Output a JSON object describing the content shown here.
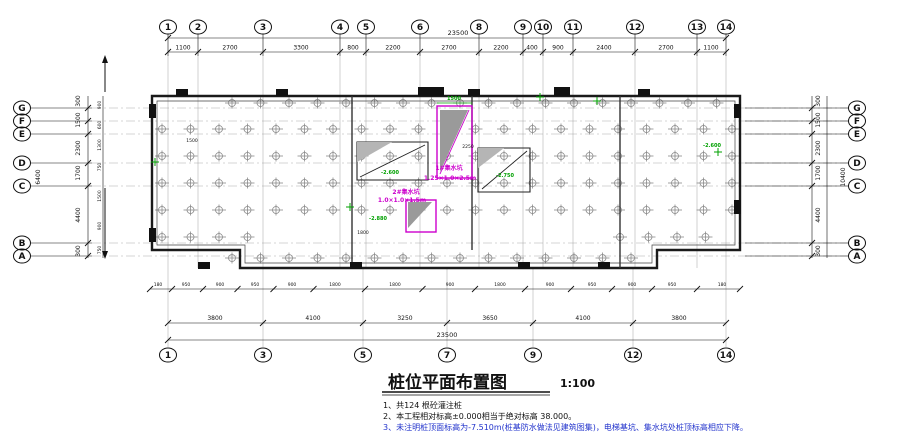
{
  "drawing": {
    "title": "桩位平面布置图",
    "scale": "1:100",
    "notes": [
      "1、共124 根砼灌注桩",
      "2、本工程相对标高±0.000相当于绝对标高 38.000。",
      "3、未注明桩顶面标高为-7.510m(桩基防水做法见建筑图集)，电梯基坑、集水坑处桩顶标高相应下降。"
    ],
    "colors": {
      "line": "#1a1a1a",
      "grid": "#999999",
      "pile": "#8a8a8a",
      "annotation_magenta": "#cc00cc",
      "elevation_green": "#00a000",
      "note3_blue": "#2233cc"
    }
  },
  "top_axis": {
    "bubbles": [
      {
        "label": "1",
        "x": 168
      },
      {
        "label": "2",
        "x": 198
      },
      {
        "label": "3",
        "x": 263
      },
      {
        "label": "4",
        "x": 340
      },
      {
        "label": "5",
        "x": 366
      },
      {
        "label": "6",
        "x": 420
      },
      {
        "label": "8",
        "x": 479
      },
      {
        "label": "9",
        "x": 523
      },
      {
        "label": "10",
        "x": 543
      },
      {
        "label": "11",
        "x": 573
      },
      {
        "label": "12",
        "x": 635
      },
      {
        "label": "13",
        "x": 697
      },
      {
        "label": "14",
        "x": 726
      }
    ],
    "dims": [
      {
        "text": "1100",
        "x": 183
      },
      {
        "text": "2700",
        "x": 230
      },
      {
        "text": "3300",
        "x": 301
      },
      {
        "text": "800",
        "x": 353
      },
      {
        "text": "2200",
        "x": 393
      },
      {
        "text": "2700",
        "x": 449
      },
      {
        "text": "2200",
        "x": 501
      },
      {
        "text": "400",
        "x": 532
      },
      {
        "text": "900",
        "x": 558
      },
      {
        "text": "2400",
        "x": 604
      },
      {
        "text": "2700",
        "x": 666
      },
      {
        "text": "1100",
        "x": 711
      }
    ],
    "total": "23500"
  },
  "bottom_axis": {
    "bubbles": [
      {
        "label": "1",
        "x": 168
      },
      {
        "label": "3",
        "x": 263
      },
      {
        "label": "5",
        "x": 363
      },
      {
        "label": "7",
        "x": 447
      },
      {
        "label": "9",
        "x": 533
      },
      {
        "label": "12",
        "x": 633
      },
      {
        "label": "14",
        "x": 726
      }
    ],
    "dims": [
      {
        "text": "3800",
        "x": 215
      },
      {
        "text": "4100",
        "x": 313
      },
      {
        "text": "3250",
        "x": 405
      },
      {
        "text": "3650",
        "x": 490
      },
      {
        "text": "4100",
        "x": 583
      },
      {
        "text": "3800",
        "x": 679
      }
    ],
    "total": "23500"
  },
  "left_axis": {
    "bubbles": [
      {
        "label": "G",
        "y": 108
      },
      {
        "label": "F",
        "y": 121
      },
      {
        "label": "E",
        "y": 134
      },
      {
        "label": "D",
        "y": 163
      },
      {
        "label": "C",
        "y": 186
      },
      {
        "label": "B",
        "y": 243
      },
      {
        "label": "A",
        "y": 256
      }
    ],
    "dims": [
      {
        "text": "300",
        "y": 101
      },
      {
        "text": "1500",
        "y": 120
      },
      {
        "text": "2300",
        "y": 148
      },
      {
        "text": "1700",
        "y": 173
      },
      {
        "text": "4400",
        "y": 215
      },
      {
        "text": "300",
        "y": 251
      }
    ],
    "inner_dims": [
      {
        "text": "900",
        "y": 105
      },
      {
        "text": "600",
        "y": 125
      },
      {
        "text": "1300",
        "y": 145
      },
      {
        "text": "750",
        "y": 167
      },
      {
        "text": "1500",
        "y": 196
      },
      {
        "text": "900",
        "y": 226
      },
      {
        "text": "750",
        "y": 250
      }
    ],
    "overall": "6400"
  },
  "right_axis": {
    "bubbles": [
      {
        "label": "G",
        "y": 108
      },
      {
        "label": "F",
        "y": 121
      },
      {
        "label": "E",
        "y": 134
      },
      {
        "label": "D",
        "y": 163
      },
      {
        "label": "C",
        "y": 186
      },
      {
        "label": "B",
        "y": 243
      },
      {
        "label": "A",
        "y": 256
      }
    ],
    "dims": [
      {
        "text": "300",
        "y": 101
      },
      {
        "text": "1500",
        "y": 120
      },
      {
        "text": "2300",
        "y": 148
      },
      {
        "text": "1700",
        "y": 173
      },
      {
        "text": "4400",
        "y": 215
      },
      {
        "text": "300",
        "y": 251
      }
    ],
    "overall": "10400"
  },
  "small_dims_row": [
    {
      "text": "180",
      "x": 158
    },
    {
      "text": "950",
      "x": 186
    },
    {
      "text": "900",
      "x": 220
    },
    {
      "text": "950",
      "x": 255
    },
    {
      "text": "900",
      "x": 292
    },
    {
      "text": "1800",
      "x": 335
    },
    {
      "text": "1800",
      "x": 395
    },
    {
      "text": "900",
      "x": 450
    },
    {
      "text": "1800",
      "x": 500
    },
    {
      "text": "900",
      "x": 550
    },
    {
      "text": "950",
      "x": 592
    },
    {
      "text": "900",
      "x": 632
    },
    {
      "text": "950",
      "x": 672
    },
    {
      "text": "180",
      "x": 722
    }
  ],
  "pit_labels": [
    {
      "text": "1#集水坑",
      "x": 449,
      "y": 170
    },
    {
      "text": "1.25×1.0×2.5m",
      "x": 450,
      "y": 180
    },
    {
      "text": "2#集水坑",
      "x": 406,
      "y": 194
    },
    {
      "text": "1.0×1.0×1.5m",
      "x": 402,
      "y": 202
    }
  ],
  "elevation_labels": [
    {
      "text": "1500",
      "x": 454,
      "y": 100
    },
    {
      "text": "-2.600",
      "x": 390,
      "y": 174
    },
    {
      "text": "-2.750",
      "x": 505,
      "y": 177
    },
    {
      "text": "-2.880",
      "x": 378,
      "y": 220
    },
    {
      "text": "-2.600",
      "x": 712,
      "y": 147
    }
  ],
  "green_marks": [
    {
      "x": 540,
      "y": 97
    },
    {
      "x": 597,
      "y": 101
    },
    {
      "x": 155,
      "y": 162
    },
    {
      "x": 350,
      "y": 207
    },
    {
      "x": 718,
      "y": 152
    }
  ],
  "black_tiny_labels": [
    {
      "text": "1500",
      "x": 192,
      "y": 142
    },
    {
      "text": "1800",
      "x": 363,
      "y": 234
    },
    {
      "text": "2250",
      "x": 468,
      "y": 148
    }
  ],
  "piles": {
    "rows": [
      {
        "y": 103,
        "x0": 232,
        "x1": 718,
        "step": 28.5
      },
      {
        "y": 129,
        "x0": 162,
        "x1": 733,
        "step": 28.5
      },
      {
        "y": 156,
        "x0": 162,
        "x1": 733,
        "step": 28.5
      },
      {
        "y": 183,
        "x0": 162,
        "x1": 733,
        "step": 28.5
      },
      {
        "y": 210,
        "x0": 162,
        "x1": 733,
        "step": 28.5
      },
      {
        "y": 237,
        "x0": 162,
        "x1": 262,
        "step": 28.5
      },
      {
        "y": 237,
        "x0": 620,
        "x1": 733,
        "step": 28.5
      },
      {
        "y": 258,
        "x0": 232,
        "x1": 642,
        "step": 28.5
      }
    ]
  }
}
